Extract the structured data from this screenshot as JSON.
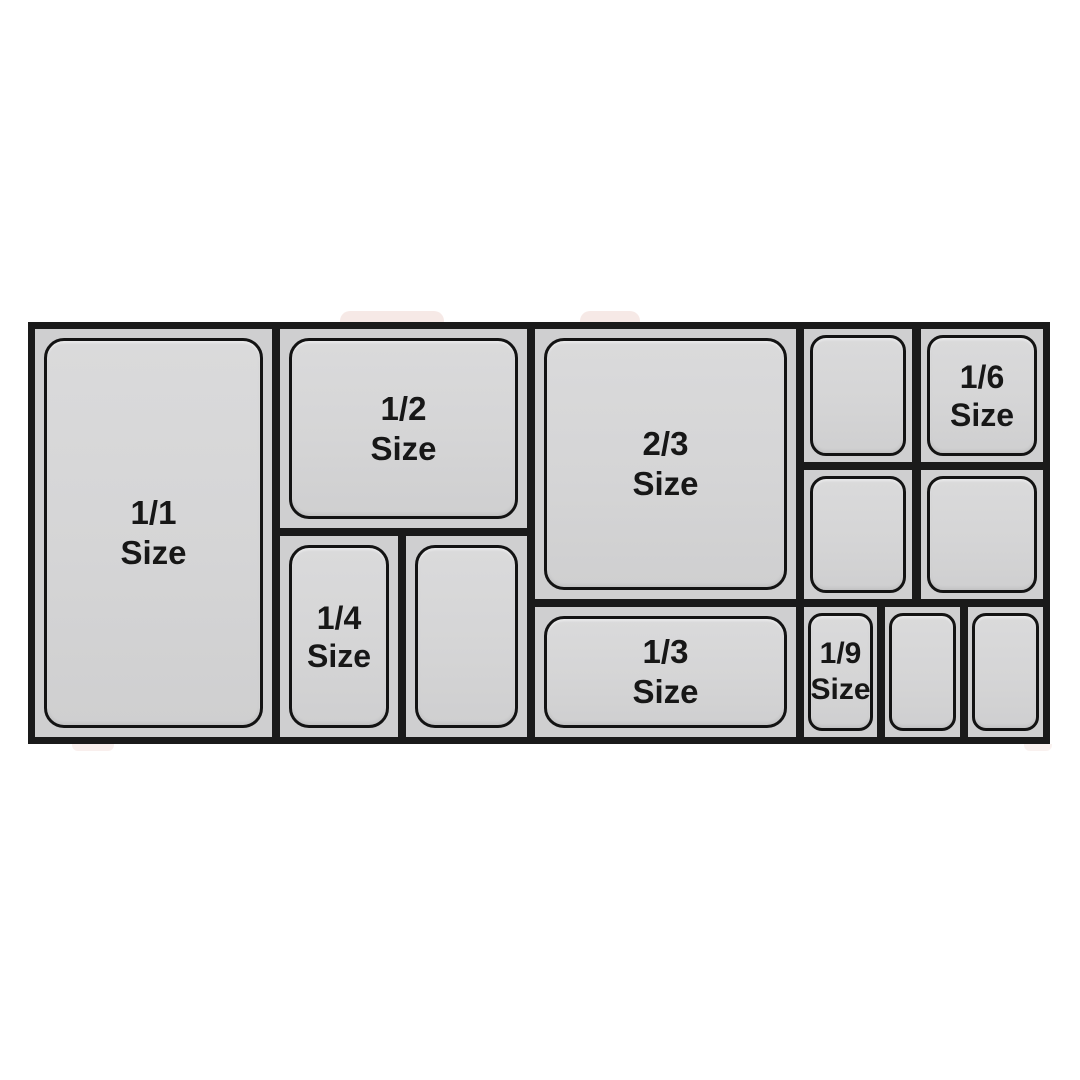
{
  "diagram": {
    "type": "gastronorm-pan-size-chart",
    "background": "#ffffff",
    "colors": {
      "divider_black": "#1a1a1a",
      "cell_background": "#cfcfd0",
      "pan_fill": "#d5d5d6",
      "pan_outline": "#131313",
      "label_text": "#171717",
      "photo_artifact_pink": "#efd7d2"
    },
    "pan_count": 13,
    "unlabeled_pan_count": 6,
    "labels": {
      "full": {
        "line1": "1/1",
        "line2": "Size"
      },
      "half": {
        "line1": "1/2",
        "line2": "Size"
      },
      "two_thirds": {
        "line1": "2/3",
        "line2": "Size"
      },
      "quarter": {
        "line1": "1/4",
        "line2": "Size"
      },
      "third": {
        "line1": "1/3",
        "line2": "Size"
      },
      "sixth": {
        "line1": "1/6",
        "line2": "Size"
      },
      "ninth": {
        "line1": "1/9",
        "line2": "Size"
      }
    },
    "pans": [
      {
        "size": "1/1",
        "labeled": true
      },
      {
        "size": "1/2",
        "labeled": true
      },
      {
        "size": "1/4",
        "labeled": true
      },
      {
        "size": "1/4",
        "labeled": false
      },
      {
        "size": "2/3",
        "labeled": true
      },
      {
        "size": "1/3",
        "labeled": true
      },
      {
        "size": "1/6",
        "labeled": false
      },
      {
        "size": "1/6",
        "labeled": true
      },
      {
        "size": "1/6",
        "labeled": false
      },
      {
        "size": "1/6",
        "labeled": false
      },
      {
        "size": "1/9",
        "labeled": true
      },
      {
        "size": "1/9",
        "labeled": false
      },
      {
        "size": "1/9",
        "labeled": false
      }
    ]
  }
}
